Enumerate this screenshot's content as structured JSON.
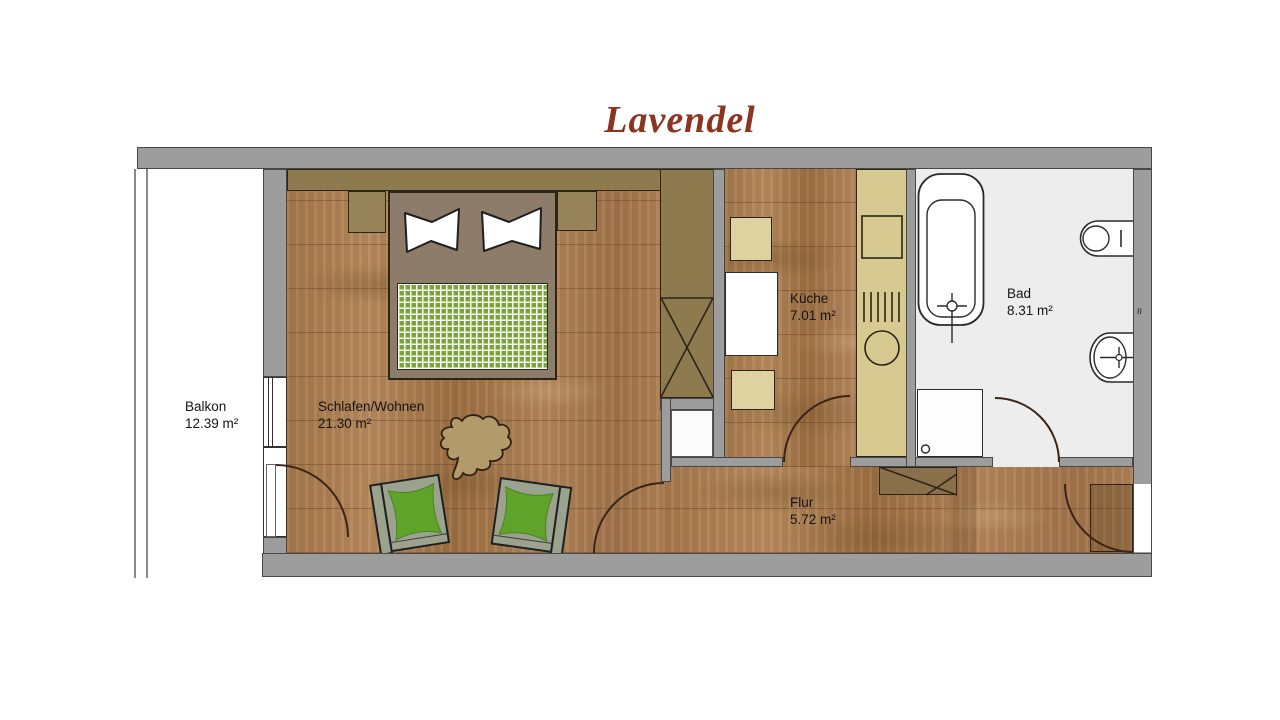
{
  "title": "Lavendel",
  "rooms": [
    {
      "name": "Balkon",
      "area": "12.39 m²"
    },
    {
      "name": "Schlafen/Wohnen",
      "area": "21.30 m²"
    },
    {
      "name": "Küche",
      "area": "7.01 m²"
    },
    {
      "name": "Bad",
      "area": "8.31 m²"
    },
    {
      "name": "Flur",
      "area": "5.72 m²"
    }
  ],
  "symbols": {
    "wall_break": "≈"
  },
  "colors": {
    "title": "#8b3520",
    "wall": "#9d9d9d",
    "wood": "#a97c4e",
    "cabinet_tan": "#8e7b4f",
    "kitchen_counter": "#d6ca90",
    "bath_floor": "#ededed",
    "blanket_green": "#79a437",
    "cushion_green": "#5fa32a",
    "chair_body": "#9ba28e"
  },
  "fixtures": [
    "double-bed",
    "pillows",
    "nightstands",
    "headboard-shelf",
    "built-in-wardrobe",
    "armchairs",
    "side-table",
    "dining-table",
    "kitchen-chairs",
    "kitchen-counter",
    "stove",
    "kitchen-sink",
    "bathtub",
    "shower",
    "toilet",
    "washbasin",
    "hall-cabinet",
    "balcony-door",
    "window",
    "entrance-door"
  ]
}
